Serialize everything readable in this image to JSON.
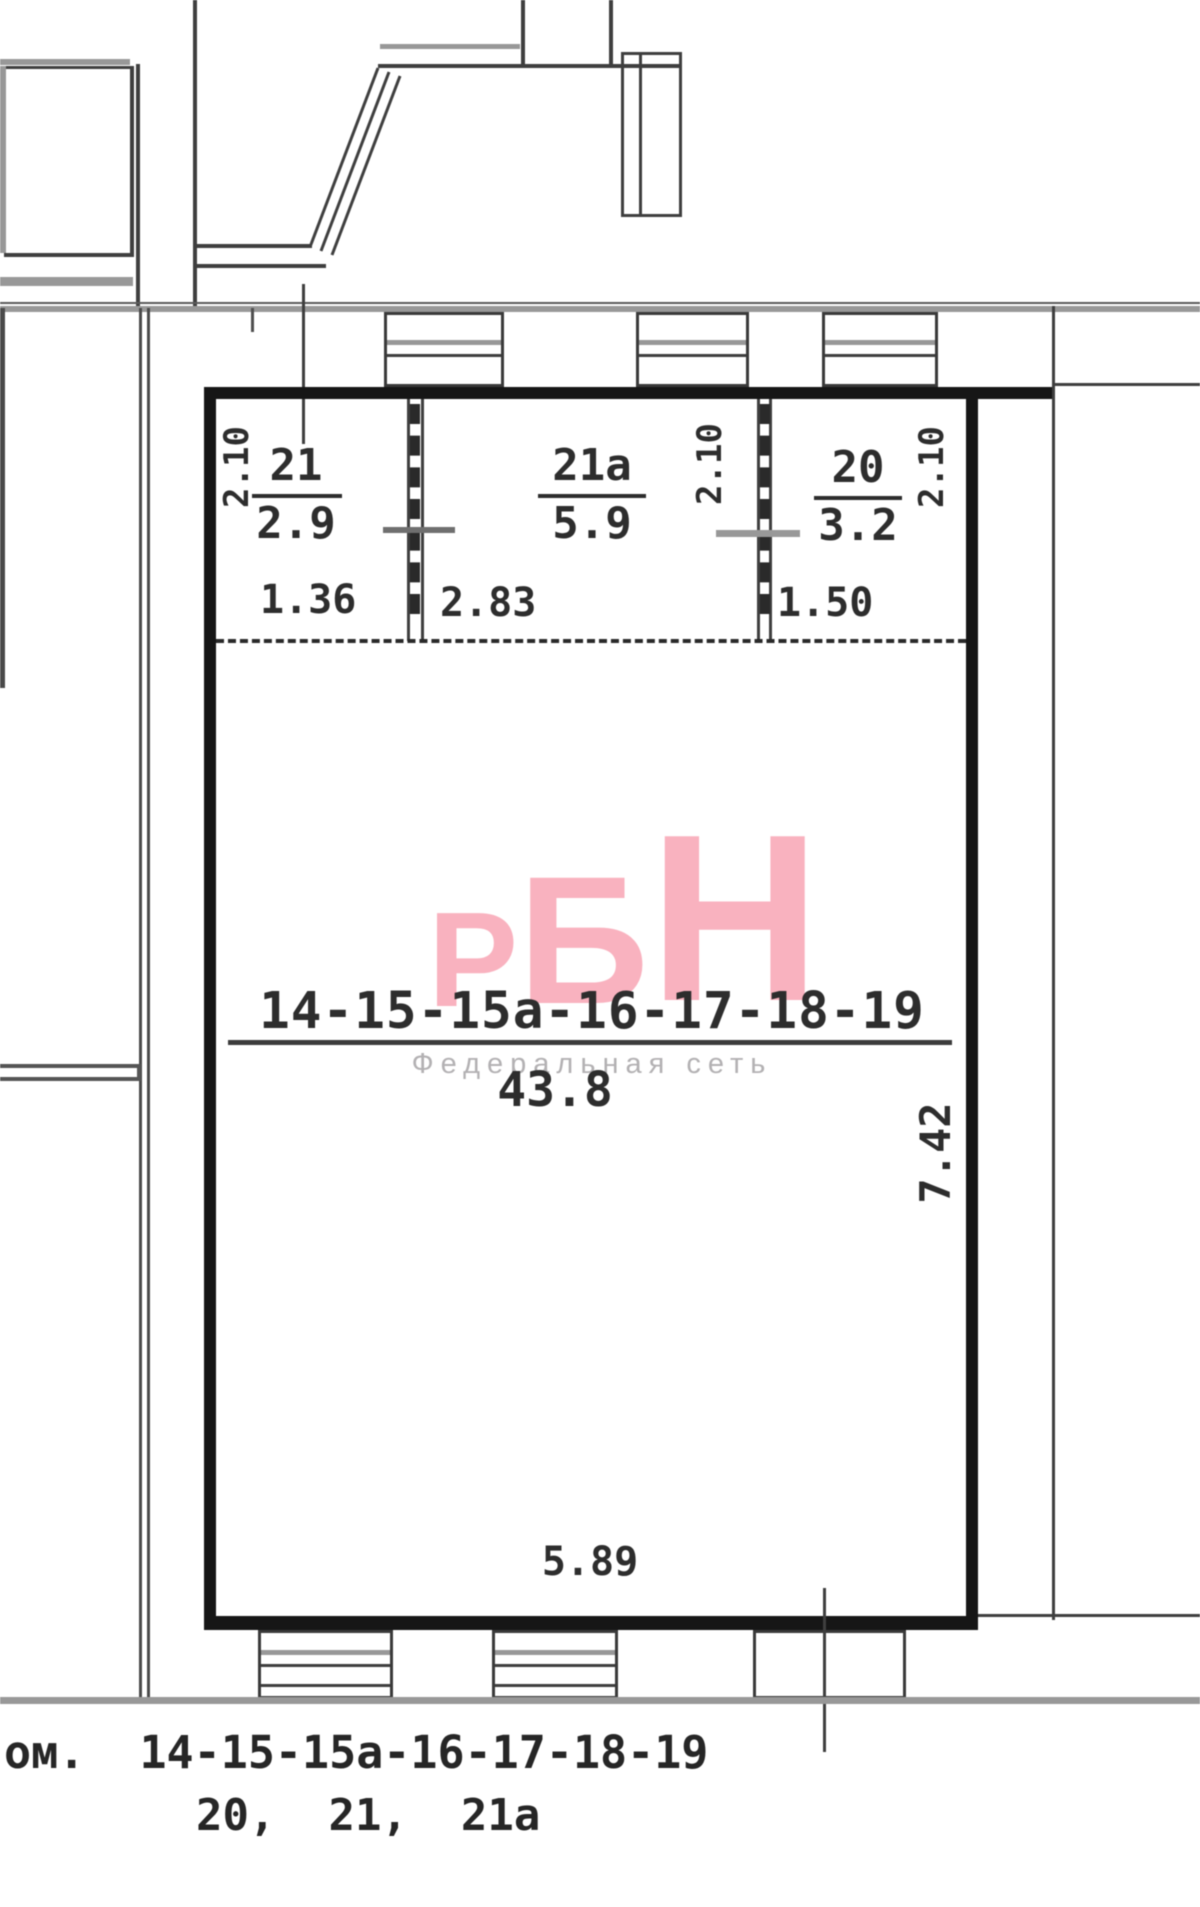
{
  "plan": {
    "rooms_small": [
      {
        "number": "21",
        "area": "2.9",
        "ceiling_height": "2.10",
        "width_dim": "1.36"
      },
      {
        "number": "21а",
        "area": "5.9",
        "ceiling_height": "2.10",
        "width_dim": "2.83"
      },
      {
        "number": "20",
        "area": "3.2",
        "ceiling_height": "2.10",
        "width_dim": "1.50"
      }
    ],
    "main_room": {
      "number": "14-15-15а-16-17-18-19",
      "area": "43.8",
      "depth_dim": "7.42",
      "width_dim": "5.89"
    }
  },
  "watermark": {
    "letters": [
      "Р",
      "Б",
      "Н"
    ],
    "subtitle": "Федеральная сеть",
    "pink": "#f9b2bf",
    "subtitle_gray": "#b3b1b3"
  },
  "caption": {
    "line1": "ом.  14-15-15а-16-17-18-19",
    "line2": "20,  21,  21а"
  }
}
